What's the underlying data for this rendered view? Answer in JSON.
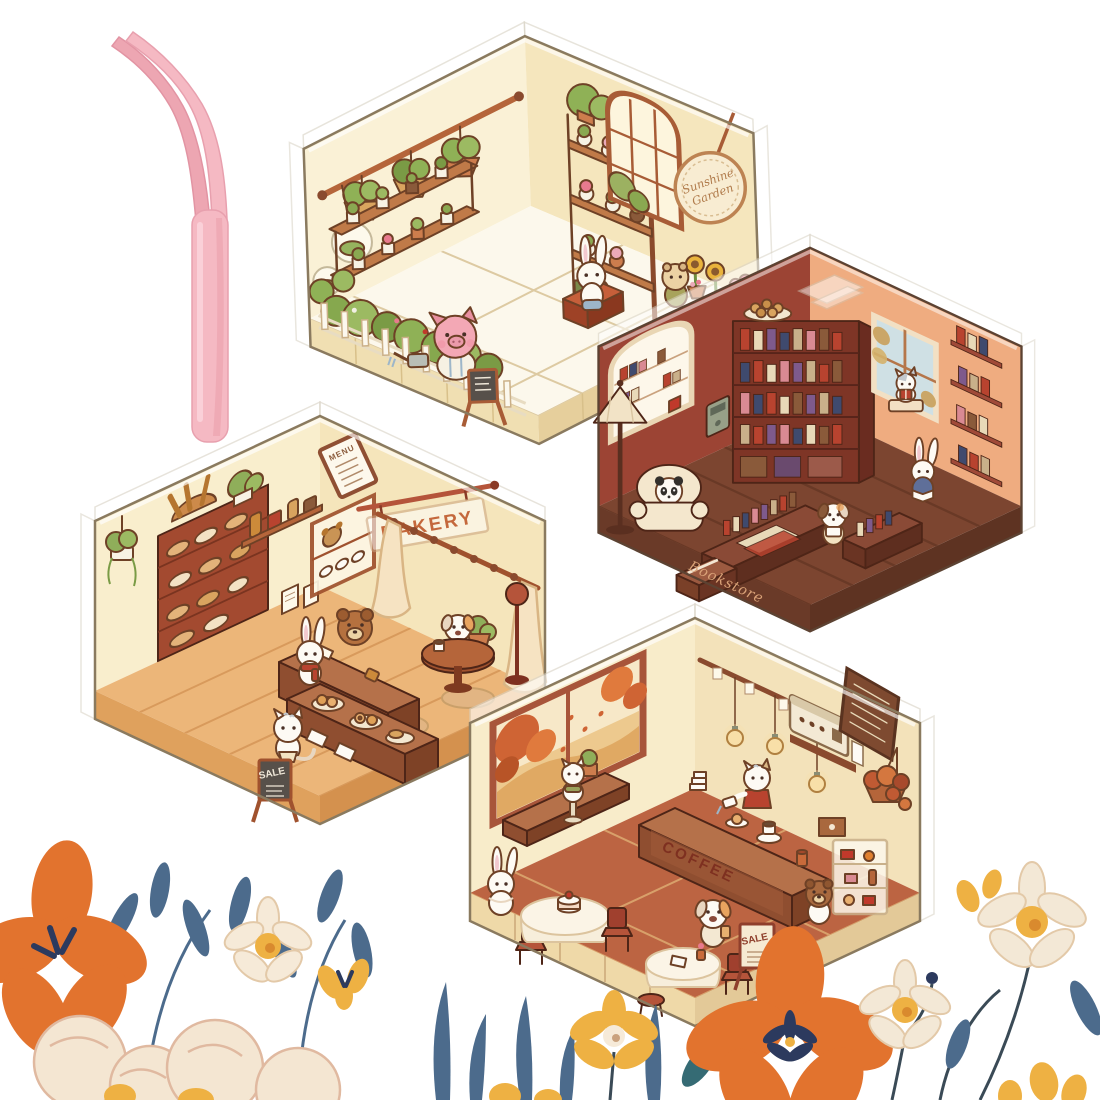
{
  "scene": {
    "background_color": "#ffffff",
    "items": [
      "pink-tweezers",
      "sunshine-garden-room",
      "bookstore-room",
      "bakery-room",
      "coffee-shop-room",
      "flower-border"
    ]
  },
  "tweezers": {
    "color": "#f5b9c3",
    "style": "curved-tip"
  },
  "rooms": {
    "garden": {
      "sign_line1": "Sunshine",
      "sign_line2": "Garden",
      "wall_color": "#faf1d6",
      "floor_color": "#fcf8ec",
      "characters": [
        "pig-gardener",
        "white-rabbit",
        "hamster"
      ],
      "features": [
        "hanging-plants",
        "plant-shelves",
        "arched-window",
        "picket-fence",
        "chalkboard-easel",
        "tool-crate"
      ]
    },
    "bookstore": {
      "base_label": "Bookstore",
      "wall_color_left": "#9c4434",
      "wall_color_right": "#efac80",
      "floor_color": "#7c4530",
      "characters": [
        "panda-reader",
        "window-cat",
        "rabbit-reader",
        "puppy-reader"
      ],
      "features": [
        "corner-bookshelf",
        "arched-window",
        "floor-lamp",
        "armchair",
        "book-tables",
        "wall-shelves",
        "cookie-plate"
      ]
    },
    "bakery": {
      "sign": "BAKERY",
      "menu_label": "MENU",
      "sale_label": "SALE",
      "wall_color": "#f9eecd",
      "floor_color": "#ecb679",
      "characters": [
        "baker-bear",
        "scarf-rabbit",
        "striped-cat",
        "cafe-puppy"
      ],
      "features": [
        "bread-shelf",
        "baguette-basket",
        "menu-board",
        "jar-shelf",
        "curtains",
        "pastry-display",
        "round-table",
        "floor-lamp",
        "sale-easel"
      ]
    },
    "coffee": {
      "counter_label": "COFFEE",
      "sale_label": "SALE",
      "wall_color": "#f8ecca",
      "floor_color": "#bc6442",
      "characters": [
        "barista-cat",
        "window-cat",
        "table-rabbit",
        "puppy-customer",
        "bear-customer"
      ],
      "features": [
        "autumn-window",
        "hanging-bulbs",
        "coffee-counter",
        "espresso-machine",
        "menu-board",
        "hanging-plant",
        "dessert-case",
        "round-tables",
        "sale-easel"
      ]
    }
  },
  "flowers": {
    "orange": "#e2732e",
    "navy": "#2c3a5e",
    "yellow": "#eeb143",
    "cream": "#f4e6d2",
    "leaf_blue": "#4c6b8c",
    "leaf_teal": "#356b74"
  }
}
